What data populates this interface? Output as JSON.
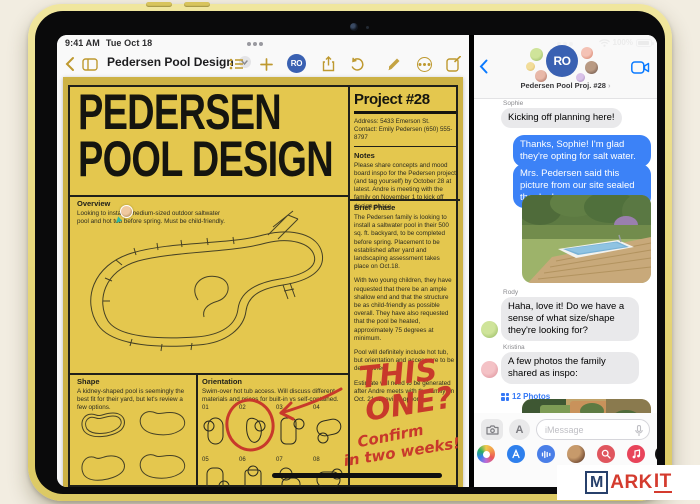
{
  "status_bar": {
    "time": "9:41 AM",
    "date": "Tue Oct 18",
    "battery_percent": "100%"
  },
  "notes_app": {
    "toolbar": {
      "title": "Pedersen Pool Design",
      "collab_logo": "RO"
    },
    "note": {
      "title_line1": "PEDERSEN",
      "title_line2": "POOL DESIGN",
      "project_heading": "Project #28",
      "address": "Address: 5433 Emerson St.",
      "contact": "Contact: Emily Pedersen (650) 555-8797",
      "notes_heading": "Notes",
      "notes_body": "Please share concepts and mood board inspo for the Pedersen project (and tag yourself) by October 28 at latest. Andre is meeting with the family on November 1 to kick off design phase.",
      "overview_heading": "Overview",
      "overview_body": "Looking to install a medium-sized outdoor saltwater pool and hot tub before spring. Must be child-friendly.",
      "brief_heading": "Brief Phase",
      "brief_p1": "The Pedersen family is looking to install a saltwater pool in their 500 sq. ft. backyard, to be completed before spring. Placement to be established after yard and landscaping assessment takes place on Oct.18.",
      "brief_p2": "With two young children, they have requested that there be an ample shallow end and that the structure be as child-friendly as possible overall. They have also requested that the pool be heated, approximately 75 degrees at minimum.",
      "brief_p3": "Pool will definitely include hot tub, but orientation and access are to be determined.",
      "brief_p4": "Estimate will need to be generated after Andre meets with the family on Oct. 21 to review options.",
      "shape_heading": "Shape",
      "shape_body": "A kidney-shaped pool is seemingly the best fit for their yard, but let's review a few options.",
      "orientation_heading": "Orientation",
      "orientation_body": "Swim-over hot tub access. Will discuss different materials and prices for built-in vs self-contained.",
      "orientation_numbers": [
        "01",
        "02",
        "03",
        "04",
        "05",
        "06",
        "07",
        "08"
      ],
      "annotation_line1": "THIS",
      "annotation_line2": "ONE?",
      "annotation_line3": "Confirm",
      "annotation_line4": "in two weeks!"
    }
  },
  "messages_app": {
    "header": {
      "logo": "RO",
      "title": "Pedersen Pool Proj. #28",
      "title_chevron": "›"
    },
    "thread": [
      {
        "sender": "Sophie",
        "text": "Kicking off planning here!"
      },
      {
        "text": "Thanks, Sophie! I'm glad they're opting for salt water."
      },
      {
        "text": "Mrs. Pedersen said this picture from our site sealed the deal:"
      },
      {
        "sender": "Rody",
        "text": "Haha, love it! Do we have a sense of what size/shape they're looking for?"
      },
      {
        "sender": "Kristina",
        "text": "A few photos the family shared as inspo:"
      }
    ],
    "photos_link": "12 Photos",
    "composer_placeholder": "iMessage",
    "app_store_letter": "A"
  },
  "watermark": {
    "m": "M",
    "ark": "ARK",
    "it": "IT"
  },
  "colors": {
    "note_yellow": "#E4C74E",
    "imessage_blue": "#3C82F7",
    "notes_gold": "#BE992F",
    "brand_navy": "#27406B",
    "brand_red": "#D43B2E",
    "marker_red": "#C8392B"
  }
}
